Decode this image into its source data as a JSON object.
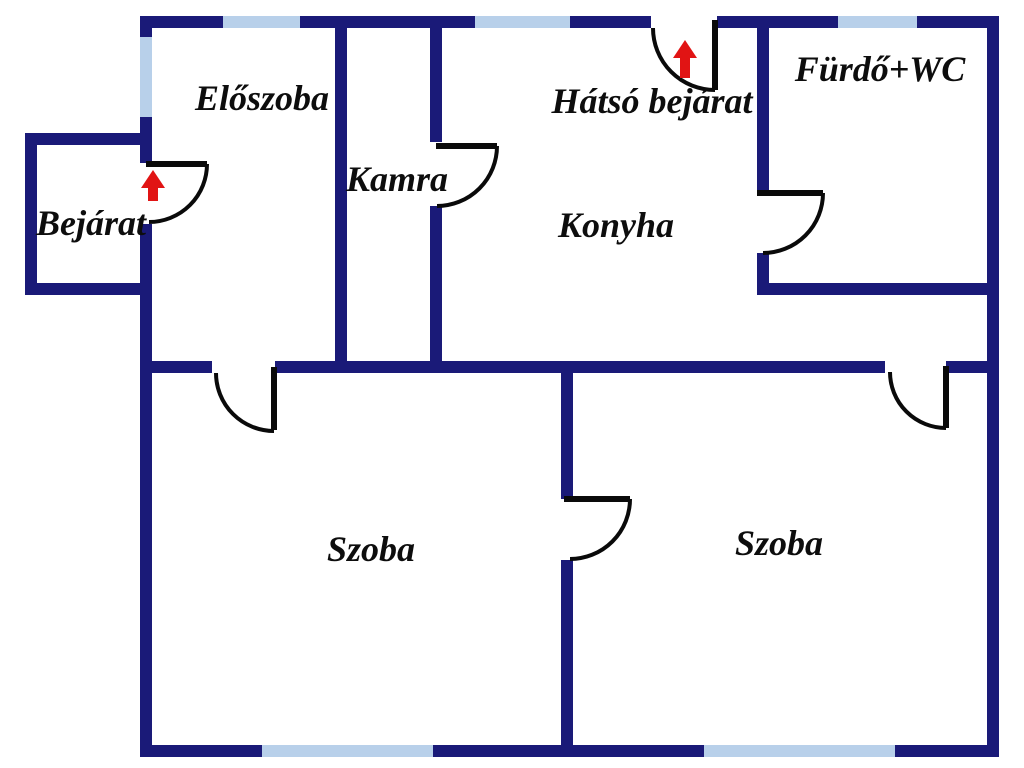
{
  "title": "Lakás alaprajz (floor plan)",
  "colors": {
    "wall": "#1a1a78",
    "window": "#b8d0ea",
    "door": "#0a0a0a",
    "arrow": "#e11414",
    "text": "#0d0d0d",
    "background": "#ffffff"
  },
  "rooms": [
    {
      "id": "eloszoba",
      "label": "Előszoba",
      "x": 262,
      "y": 98
    },
    {
      "id": "kamra",
      "label": "Kamra",
      "x": 397,
      "y": 179
    },
    {
      "id": "hatso-bejarat",
      "label": "Hátsó bejárat",
      "x": 652,
      "y": 101
    },
    {
      "id": "furdo-wc",
      "label": "Fürdő+WC",
      "x": 880,
      "y": 69
    },
    {
      "id": "bejarat",
      "label": "Bejárat",
      "x": 91,
      "y": 223
    },
    {
      "id": "konyha",
      "label": "Konyha",
      "x": 616,
      "y": 225
    },
    {
      "id": "szoba-1",
      "label": "Szoba",
      "x": 371,
      "y": 549
    },
    {
      "id": "szoba-2",
      "label": "Szoba",
      "x": 779,
      "y": 543
    }
  ],
  "floorplan": {
    "width": 1024,
    "height": 768,
    "walls": [
      [
        140,
        16,
        83,
        12
      ],
      [
        300,
        16,
        175,
        12
      ],
      [
        570,
        16,
        81,
        12
      ],
      [
        717,
        16,
        282,
        12
      ],
      [
        140,
        16,
        12,
        21
      ],
      [
        140,
        117,
        12,
        46
      ],
      [
        140,
        224,
        12,
        533
      ],
      [
        987,
        16,
        12,
        741
      ],
      [
        140,
        745,
        122,
        12
      ],
      [
        433,
        745,
        271,
        12
      ],
      [
        895,
        745,
        104,
        12
      ],
      [
        25,
        133,
        12,
        162
      ],
      [
        25,
        133,
        115,
        12
      ],
      [
        25,
        283,
        115,
        12
      ],
      [
        140,
        361,
        72,
        12
      ],
      [
        275,
        361,
        610,
        12
      ],
      [
        946,
        361,
        53,
        12
      ],
      [
        335,
        28,
        12,
        333
      ],
      [
        430,
        28,
        12,
        114
      ],
      [
        430,
        206,
        12,
        155
      ],
      [
        757,
        28,
        12,
        164
      ],
      [
        757,
        253,
        12,
        42
      ],
      [
        757,
        283,
        242,
        12
      ],
      [
        561,
        373,
        12,
        126
      ],
      [
        561,
        560,
        12,
        185
      ]
    ],
    "windows": [
      [
        223,
        16,
        77,
        12
      ],
      [
        475,
        16,
        95,
        12
      ],
      [
        838,
        16,
        79,
        12
      ],
      [
        140,
        37,
        12,
        80
      ],
      [
        262,
        745,
        171,
        12
      ],
      [
        704,
        745,
        191,
        12
      ]
    ],
    "doors": [
      {
        "name": "main-entrance-door",
        "leaf": [
          146,
          164,
          207,
          164
        ],
        "arc": "M 207 164 A 58 58 0 0 1 149 222"
      },
      {
        "name": "eloszoba-szoba-door",
        "leaf": [
          274,
          367,
          274,
          430
        ],
        "arc": "M 216 373 A 58 58 0 0 0 274 431"
      },
      {
        "name": "kamra-door",
        "leaf": [
          436,
          146,
          497,
          146
        ],
        "arc": "M 497 146 A 60 60 0 0 1 437 206"
      },
      {
        "name": "back-entrance-door",
        "leaf": [
          715,
          20,
          715,
          90
        ],
        "arc": "M 653 28 A 62 62 0 0 0 715 90"
      },
      {
        "name": "furdo-door",
        "leaf": [
          757,
          193,
          823,
          193
        ],
        "arc": "M 823 193 A 60 60 0 0 1 763 253"
      },
      {
        "name": "konyha-szoba-door",
        "leaf": [
          946,
          366,
          946,
          428
        ],
        "arc": "M 890 372 A 56 56 0 0 0 946 428"
      },
      {
        "name": "szoba-szoba-door",
        "leaf": [
          564,
          499,
          630,
          499
        ],
        "arc": "M 630 499 A 60 60 0 0 1 570 559"
      }
    ],
    "arrows": [
      {
        "name": "main-entrance-arrow-icon",
        "points": "153,170 165,188 158,188 158,201 148,201 148,188 141,188"
      },
      {
        "name": "back-entrance-arrow-icon",
        "points": "685,40 697,58 690,58 690,78 680,78 680,58 673,58"
      }
    ]
  }
}
